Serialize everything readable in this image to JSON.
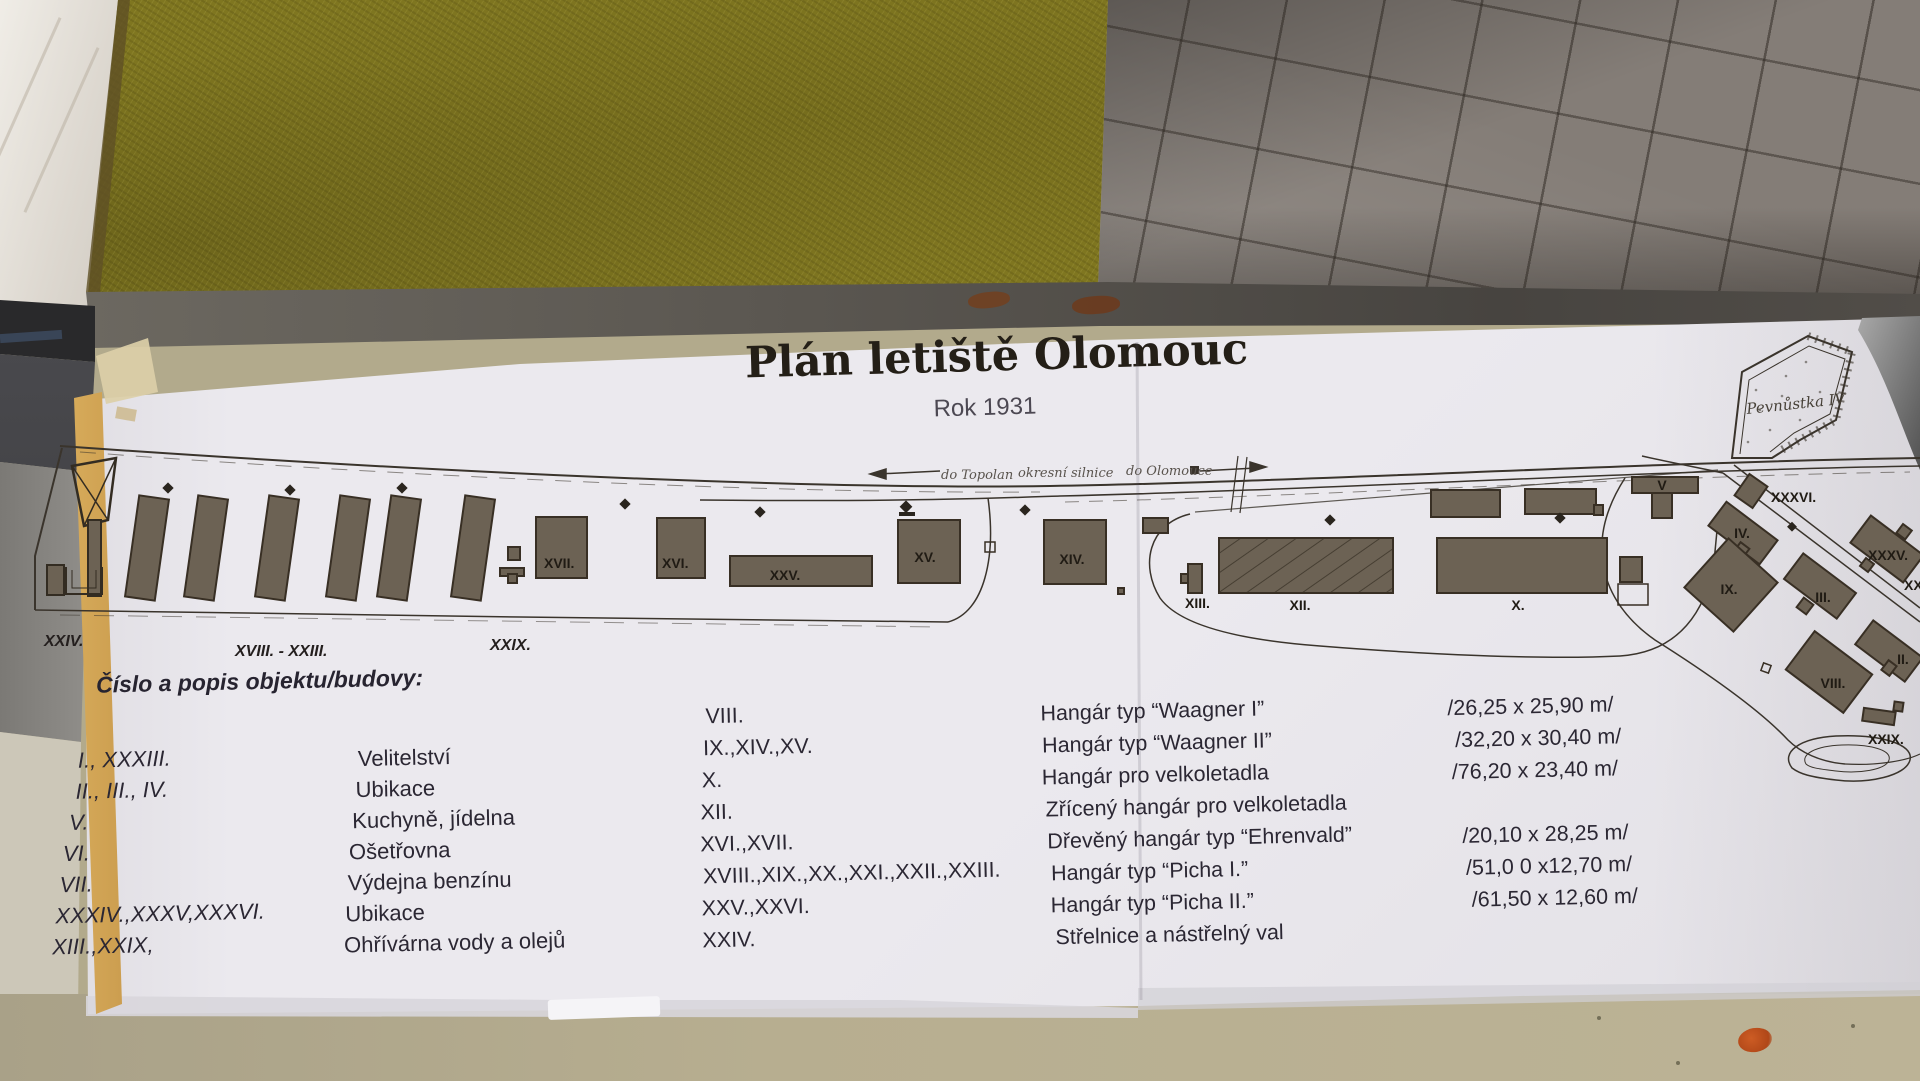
{
  "palette": {
    "felt": "#7f7620",
    "paving": "#847d77",
    "paper": "#ebe9ee",
    "ink": "#2b2733",
    "building_fill": "#6c6254",
    "table": "#b2aa8c",
    "stain": "#b04718"
  },
  "title": {
    "main": "Plán letiště Olomouc",
    "subtitle": "Rok 1931"
  },
  "legend": {
    "heading": "Číslo a popis objektu/budovy:",
    "rows_left": [
      {
        "num": "I., XXXIII.",
        "name": "Velitelství"
      },
      {
        "num": "II., III., IV.",
        "name": "Ubikace"
      },
      {
        "num": "V.",
        "name": "Kuchyně, jídelna"
      },
      {
        "num": "VI.",
        "name": "Ošetřovna"
      },
      {
        "num": "VII.",
        "name": "Výdejna benzínu"
      },
      {
        "num": "XXXIV.,XXXV,XXXVI.",
        "name": "Ubikace"
      },
      {
        "num": "XIII.,XXIX,",
        "name": "Ohřívárna vody a olejů"
      }
    ],
    "rows_right": [
      {
        "num": "VIII.",
        "name": "Hangár typ “Waagner I”",
        "dim": "/26,25 x 25,90 m/"
      },
      {
        "num": "IX.,XIV.,XV.",
        "name": "Hangár typ “Waagner II”",
        "dim": "/32,20 x 30,40 m/"
      },
      {
        "num": "X.",
        "name": "Hangár pro velkoletadla",
        "dim": "/76,20 x 23,40 m/"
      },
      {
        "num": "XII.",
        "name": "Zřícený hangár pro velkoletadla",
        "dim": ""
      },
      {
        "num": "XVI.,XVII.",
        "name": "Dřevěný hangár  typ “Ehrenvald”",
        "dim": "/20,10 x 28,25 m/"
      },
      {
        "num": "XVIII.,XIX.,XX.,XXI.,XXII.,XXIII.",
        "name": "Hangár typ “Picha I.”",
        "dim": "/51,0 0 x12,70 m/"
      },
      {
        "num": "XXV.,XXVI.",
        "name": "Hangár typ “Picha II.”",
        "dim": "/61,50 x 12,60 m/"
      },
      {
        "num": "XXIV.",
        "name": "Střelnice a nástřelný val",
        "dim": ""
      }
    ]
  },
  "map": {
    "strip_labels": {
      "left": "XXIV.",
      "mid": "XVIII. - XXIII.",
      "right": "XXIX."
    },
    "road_labels": {
      "west": "do Topolan",
      "mid": "okresní silnice",
      "east": "do Olomouce"
    },
    "fort": "Pevnůstka IV",
    "labels": {
      "x17": "XVII.",
      "x16": "XVI.",
      "x25": "XXV.",
      "x15": "XV.",
      "x14": "XIV.",
      "x13": "XIII.",
      "x12": "XII.",
      "x10": "X.",
      "xv": "V",
      "x36": "XXXVI.",
      "x4": "IV.",
      "x9": "IX.",
      "x3": "III.",
      "x35": "XXXV.",
      "x8": "VIII.",
      "x2": "II.",
      "x29": "XXIX.",
      "x34": "XXXIV."
    }
  }
}
